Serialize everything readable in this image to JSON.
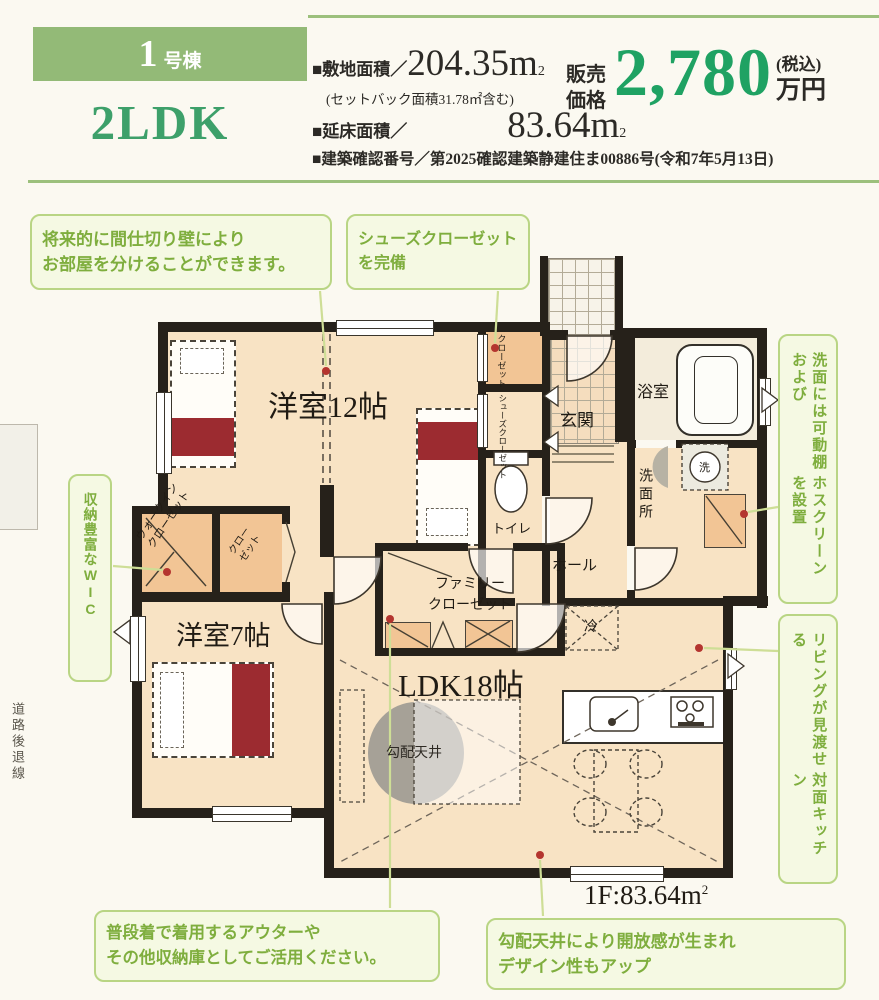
{
  "header": {
    "badge_number": "1",
    "badge_suffix": "号棟",
    "layout": "2LDK",
    "site_label": "■敷地面積／",
    "site_value": "204.35m",
    "site_sup": "2",
    "setback_note": "(セットバック面積31.78㎡含む)",
    "floor_label": "■延床面積／",
    "floor_value": "83.64m",
    "floor_sup": "2",
    "confirmation": "■建築確認番号／第2025確認建築静建住ま00886号(令和7年5月13日)",
    "price_label_1": "販売",
    "price_label_2": "価格",
    "price_amount": "2,780",
    "price_tax": "(税込)",
    "price_unit": "万円"
  },
  "rooms": {
    "western12": "洋室12帖",
    "western7": "洋室7帖",
    "ldk": "LDK18帖",
    "genkan": "玄関",
    "bath": "浴室",
    "washroom": "洗面所",
    "toilet": "トイレ",
    "hall": "ホール",
    "family_closet_1": "ファミリー",
    "family_closet_2": "クローゼット",
    "wic_1": "ウォークイン",
    "wic_2": "クローゼット",
    "closet_1": "クロー",
    "closet_2": "ゼット",
    "shoes_closet_1": "シューズ",
    "shoes_closet_2": "クローゼット",
    "mid_closet_1": "クロー",
    "mid_closet_2": "ゼット",
    "slope_ceiling": "勾配天井",
    "fridge": "冷",
    "washer": "洗",
    "floor_area": "1F:83.64m",
    "floor_area_sup": "2"
  },
  "callouts": {
    "partition_l1": "将来的に間仕切り壁により",
    "partition_l2": "お部屋を分けることができます。",
    "shoes_l1": "シューズクローゼット",
    "shoes_l2": "を完備",
    "washroom_c1": "洗面には可動棚および",
    "washroom_c2": "ホスクリーンを設置",
    "kitchen_c1": "リビングが見渡せる",
    "kitchen_c2": "対面キッチン",
    "wic": "収納豊富なWIC",
    "outer_l1": "普段着で着用するアウターや",
    "outer_l2": "その他収納庫としてご活用ください。",
    "ceiling_l1": "勾配天井により開放感が生まれ",
    "ceiling_l2": "デザイン性もアップ"
  },
  "margin": {
    "road_setback": "道路後退線"
  },
  "colors": {
    "accent_green": "#93ba77",
    "price_green": "#1fa263",
    "callout_green": "#7fae3e",
    "callout_border": "#b9d584",
    "floor": "#f8e3c4",
    "closet": "#f2c595",
    "bed_red": "#9c2b30",
    "wall": "#26211a"
  }
}
